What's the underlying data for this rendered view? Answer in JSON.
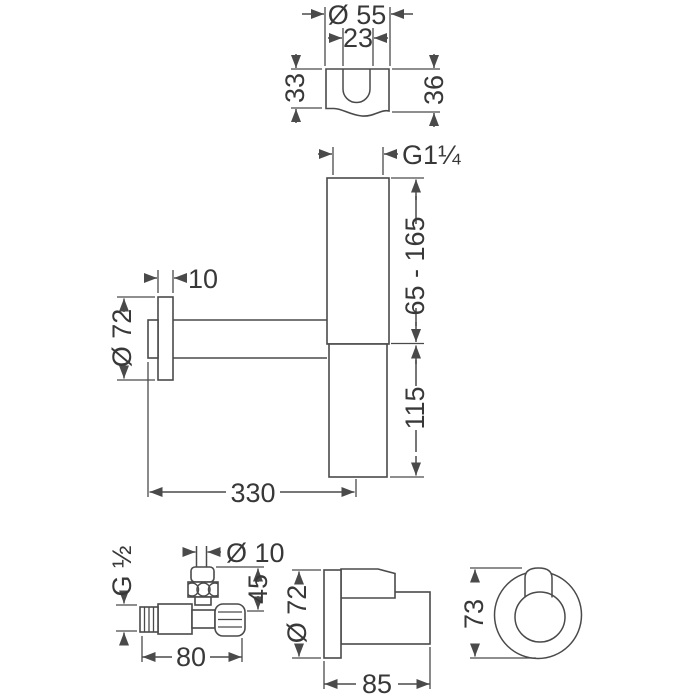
{
  "colors": {
    "line": "#4a4a4a",
    "text": "#383838",
    "background": "#ffffff"
  },
  "labels": {
    "bracket_view": {
      "outer_diameter": "Ø 55",
      "slot_width": "23",
      "height_left": "33",
      "height_right": "36"
    },
    "main_view": {
      "thread_size": "G1¼",
      "adjustment_range": "65 - 165",
      "body_height": "115",
      "rosette_diameter": "Ø 72",
      "rosette_depth": "10",
      "projection": "330"
    },
    "valve_view": {
      "outlet_diameter": "Ø 10",
      "thread_size": "G ½",
      "height": "45",
      "length": "80"
    },
    "outlet_side_view": {
      "rosette_diameter": "Ø 72",
      "depth": "85"
    },
    "outlet_front_view": {
      "height": "73"
    }
  }
}
